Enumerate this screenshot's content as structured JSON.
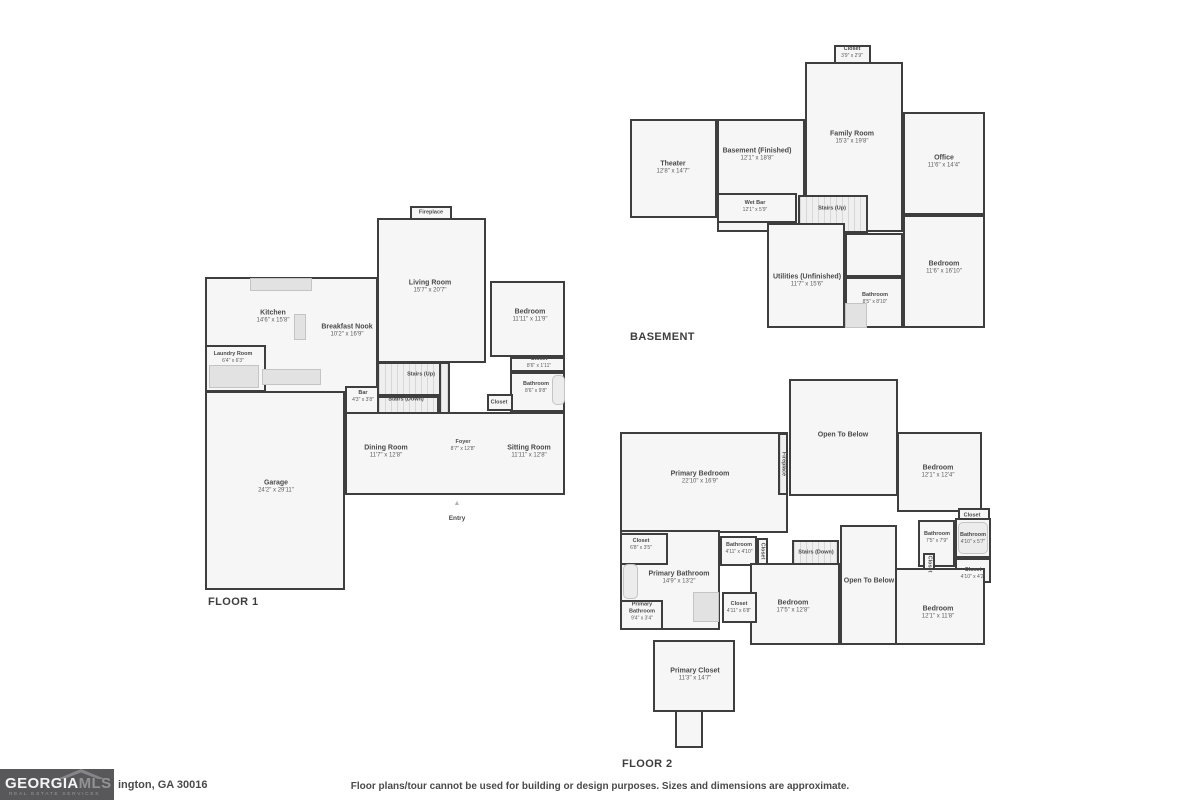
{
  "colors": {
    "wall": "#3e3e3e",
    "room_fill": "#f6f6f6",
    "label_text": "#4a4a4a",
    "logo_bg": "#58585a"
  },
  "footer": {
    "logo_text_1": "GEORGIA",
    "logo_text_2": "MLS",
    "logo_subtext": "REAL ESTATE SERVICES",
    "address": "ington, GA 30016",
    "disclaimer": "Floor plans/tour cannot be used for building or design purposes. Sizes and dimensions are approximate."
  },
  "floorplans": [
    {
      "name": "floor-1",
      "items": [
        {
          "kind": "rect",
          "name": "living-room",
          "x": 377,
          "y": 218,
          "w": 109,
          "h": 145
        },
        {
          "kind": "rect",
          "name": "fireplace-box",
          "x": 410,
          "y": 206,
          "w": 42,
          "h": 14
        },
        {
          "kind": "rect",
          "name": "kitchen-breakfast-area",
          "x": 205,
          "y": 277,
          "w": 173,
          "h": 116
        },
        {
          "kind": "rect",
          "name": "laundry-room",
          "x": 205,
          "y": 345,
          "w": 61,
          "h": 47
        },
        {
          "kind": "rect",
          "name": "garage",
          "x": 205,
          "y": 391,
          "w": 140,
          "h": 199
        },
        {
          "kind": "rect",
          "name": "bar-nook",
          "x": 345,
          "y": 386,
          "w": 35,
          "h": 28
        },
        {
          "kind": "stairs",
          "name": "stairs-up",
          "x": 377,
          "y": 362,
          "w": 73,
          "h": 34
        },
        {
          "kind": "stairs",
          "name": "stairs-down",
          "x": 377,
          "y": 396,
          "w": 62,
          "h": 36
        },
        {
          "kind": "stairs",
          "name": "stair-shaft",
          "x": 439,
          "y": 362,
          "w": 11,
          "h": 128
        },
        {
          "kind": "rect",
          "name": "dining-foyer-sitting-area",
          "x": 345,
          "y": 412,
          "w": 220,
          "h": 83
        },
        {
          "kind": "rect",
          "name": "bedroom",
          "x": 490,
          "y": 281,
          "w": 75,
          "h": 76
        },
        {
          "kind": "rect",
          "name": "closet",
          "x": 510,
          "y": 357,
          "w": 55,
          "h": 15
        },
        {
          "kind": "rect",
          "name": "bathroom",
          "x": 510,
          "y": 372,
          "w": 55,
          "h": 40
        },
        {
          "kind": "rect",
          "name": "foyer-closet",
          "x": 487,
          "y": 394,
          "w": 26,
          "h": 17
        },
        {
          "kind": "fixture",
          "name": "kitchen-counter",
          "x": 250,
          "y": 278,
          "w": 62,
          "h": 13
        },
        {
          "kind": "fixture",
          "name": "kitchen-island",
          "x": 294,
          "y": 314,
          "w": 12,
          "h": 26
        },
        {
          "kind": "fixture",
          "name": "laundry-appliances",
          "x": 209,
          "y": 365,
          "w": 50,
          "h": 23
        },
        {
          "kind": "fixture",
          "name": "kitchen-appliances",
          "x": 262,
          "y": 369,
          "w": 59,
          "h": 16
        },
        {
          "kind": "fixture",
          "name": "bathtub",
          "x": 552,
          "y": 375,
          "w": 13,
          "h": 30,
          "cls": "tub"
        },
        {
          "kind": "label",
          "name": "fireplace-label",
          "text": "Fireplace",
          "x": 431,
          "y": 213,
          "sm": true
        },
        {
          "kind": "label",
          "name": "living-room-label",
          "text": "Living Room",
          "dims": "15'7\" x 20'7\"",
          "x": 430,
          "y": 287
        },
        {
          "kind": "label",
          "name": "kitchen-label",
          "text": "Kitchen",
          "dims": "14'6\" x 15'8\"",
          "x": 273,
          "y": 317
        },
        {
          "kind": "label",
          "name": "breakfast-nook-label",
          "text": "Breakfast Nook",
          "dims": "10'2\" x 16'9\"",
          "x": 347,
          "y": 331
        },
        {
          "kind": "label",
          "name": "laundry-room-label",
          "text": "Laundry Room",
          "dims": "6'4\" x 6'3\"",
          "x": 233,
          "y": 358,
          "sm": true
        },
        {
          "kind": "label",
          "name": "bar-label",
          "text": "Bar",
          "dims": "4'3\" x 3'8\"",
          "x": 363,
          "y": 397,
          "sm": true
        },
        {
          "kind": "label",
          "name": "stairs-up-label",
          "text": "Stairs (Up)",
          "x": 421,
          "y": 375,
          "sm": true
        },
        {
          "kind": "label",
          "name": "stairs-down-label",
          "text": "Stairs (Down)",
          "x": 406,
          "y": 400,
          "sm": true
        },
        {
          "kind": "label",
          "name": "bedroom-label",
          "text": "Bedroom",
          "dims": "11'11\" x 11'9\"",
          "x": 530,
          "y": 316
        },
        {
          "kind": "label",
          "name": "closet-label",
          "text": "Closet",
          "dims": "8'6\" x 1'11\"",
          "x": 539,
          "y": 363,
          "sm": true
        },
        {
          "kind": "label",
          "name": "bathroom-label",
          "text": "Bathroom",
          "dims": "8'6\" x 9'8\"",
          "x": 536,
          "y": 388,
          "sm": true
        },
        {
          "kind": "label",
          "name": "foyer-closet-label",
          "text": "Closet",
          "x": 499,
          "y": 403,
          "sm": true
        },
        {
          "kind": "label",
          "name": "dining-room-label",
          "text": "Dining Room",
          "dims": "11'7\" x 12'8\"",
          "x": 386,
          "y": 452
        },
        {
          "kind": "label",
          "name": "foyer-label",
          "text": "Foyer",
          "dims": "8'7\" x 12'8\"",
          "x": 463,
          "y": 446,
          "sm": true
        },
        {
          "kind": "label",
          "name": "sitting-room-label",
          "text": "Sitting Room",
          "dims": "11'11\" x 12'8\"",
          "x": 529,
          "y": 452
        },
        {
          "kind": "label",
          "name": "garage-label",
          "text": "Garage",
          "dims": "24'2\" x 29'11\"",
          "x": 276,
          "y": 487
        },
        {
          "kind": "entry",
          "name": "entry-marker",
          "text": "Entry",
          "x": 457,
          "y": 500
        },
        {
          "kind": "title",
          "name": "floor-1-title",
          "text": "FLOOR 1",
          "x": 208,
          "y": 596
        }
      ]
    },
    {
      "name": "basement",
      "items": [
        {
          "kind": "rect",
          "name": "closet-top",
          "x": 834,
          "y": 45,
          "w": 37,
          "h": 20
        },
        {
          "kind": "rect",
          "name": "family-room",
          "x": 805,
          "y": 62,
          "w": 98,
          "h": 170
        },
        {
          "kind": "rect",
          "name": "theater",
          "x": 630,
          "y": 119,
          "w": 87,
          "h": 99
        },
        {
          "kind": "rect",
          "name": "basement-finished",
          "x": 717,
          "y": 119,
          "w": 88,
          "h": 113
        },
        {
          "kind": "rect",
          "name": "office",
          "x": 903,
          "y": 112,
          "w": 82,
          "h": 103
        },
        {
          "kind": "rect",
          "name": "wet-bar",
          "x": 717,
          "y": 193,
          "w": 80,
          "h": 30
        },
        {
          "kind": "stairs",
          "name": "stairs-up",
          "x": 798,
          "y": 195,
          "w": 70,
          "h": 38
        },
        {
          "kind": "rect",
          "name": "utilities",
          "x": 767,
          "y": 223,
          "w": 78,
          "h": 105
        },
        {
          "kind": "rect",
          "name": "hallway",
          "x": 845,
          "y": 233,
          "w": 58,
          "h": 44
        },
        {
          "kind": "rect",
          "name": "bathroom",
          "x": 845,
          "y": 277,
          "w": 58,
          "h": 51
        },
        {
          "kind": "rect",
          "name": "bedroom",
          "x": 903,
          "y": 215,
          "w": 82,
          "h": 113
        },
        {
          "kind": "fixture",
          "name": "basement-closet",
          "x": 845,
          "y": 303,
          "w": 22,
          "h": 25
        },
        {
          "kind": "label",
          "name": "closet-top-label",
          "text": "Closet",
          "dims": "3'9\" x 2'9\"",
          "x": 852,
          "y": 53,
          "sm": true
        },
        {
          "kind": "label",
          "name": "family-room-label",
          "text": "Family Room",
          "dims": "15'3\" x 19'8\"",
          "x": 852,
          "y": 138
        },
        {
          "kind": "label",
          "name": "theater-label",
          "text": "Theater",
          "dims": "12'8\" x 14'7\"",
          "x": 673,
          "y": 168
        },
        {
          "kind": "label",
          "name": "basement-finished-label",
          "text": "Basement (Finished)",
          "dims": "12'1\" x 18'8\"",
          "x": 757,
          "y": 155
        },
        {
          "kind": "label",
          "name": "office-label",
          "text": "Office",
          "dims": "11'6\" x 14'4\"",
          "x": 944,
          "y": 162
        },
        {
          "kind": "label",
          "name": "wet-bar-label",
          "text": "Wet Bar",
          "dims": "12'1\" x 5'9\"",
          "x": 755,
          "y": 207,
          "sm": true
        },
        {
          "kind": "label",
          "name": "stairs-up-label",
          "text": "Stairs (Up)",
          "x": 832,
          "y": 209,
          "sm": true
        },
        {
          "kind": "label",
          "name": "utilities-label",
          "text": "Utilities (Unfinished)",
          "dims": "11'7\" x 15'6\"",
          "x": 807,
          "y": 281
        },
        {
          "kind": "label",
          "name": "bathroom-label",
          "text": "Bathroom",
          "dims": "8'5\" x 8'10\"",
          "x": 875,
          "y": 299,
          "sm": true
        },
        {
          "kind": "label",
          "name": "bedroom-label",
          "text": "Bedroom",
          "dims": "11'6\" x 16'10\"",
          "x": 944,
          "y": 268
        },
        {
          "kind": "title",
          "name": "basement-title",
          "text": "BASEMENT",
          "x": 630,
          "y": 331
        }
      ]
    },
    {
      "name": "floor-2",
      "items": [
        {
          "kind": "rect",
          "name": "open-to-below-top",
          "x": 789,
          "y": 379,
          "w": 109,
          "h": 117
        },
        {
          "kind": "rect",
          "name": "primary-bedroom",
          "x": 620,
          "y": 432,
          "w": 168,
          "h": 101
        },
        {
          "kind": "stairs",
          "name": "fireplace-strip",
          "x": 778,
          "y": 433,
          "w": 10,
          "h": 62
        },
        {
          "kind": "rect",
          "name": "bedroom-top-right",
          "x": 897,
          "y": 432,
          "w": 85,
          "h": 80
        },
        {
          "kind": "rect",
          "name": "closet-bump",
          "x": 958,
          "y": 508,
          "w": 32,
          "h": 20
        },
        {
          "kind": "rect",
          "name": "bathroom-right-1",
          "x": 918,
          "y": 520,
          "w": 37,
          "h": 47
        },
        {
          "kind": "rect",
          "name": "closet-vert-right",
          "x": 923,
          "y": 553,
          "w": 12,
          "h": 22
        },
        {
          "kind": "rect",
          "name": "bathroom-right-2",
          "x": 955,
          "y": 518,
          "w": 36,
          "h": 40
        },
        {
          "kind": "rect",
          "name": "closet-right-2",
          "x": 955,
          "y": 558,
          "w": 36,
          "h": 25
        },
        {
          "kind": "rect",
          "name": "bedroom-bottom-right",
          "x": 870,
          "y": 568,
          "w": 115,
          "h": 77
        },
        {
          "kind": "rect",
          "name": "primary-bathroom",
          "x": 620,
          "y": 530,
          "w": 100,
          "h": 100
        },
        {
          "kind": "rect",
          "name": "closet-left",
          "x": 620,
          "y": 533,
          "w": 48,
          "h": 32
        },
        {
          "kind": "rect",
          "name": "bathroom-center",
          "x": 720,
          "y": 536,
          "w": 37,
          "h": 30
        },
        {
          "kind": "rect",
          "name": "closet-vert-center",
          "x": 757,
          "y": 538,
          "w": 11,
          "h": 27
        },
        {
          "kind": "stairs",
          "name": "stairs-down",
          "x": 792,
          "y": 540,
          "w": 47,
          "h": 27
        },
        {
          "kind": "rect",
          "name": "open-to-below-center",
          "x": 840,
          "y": 525,
          "w": 57,
          "h": 120
        },
        {
          "kind": "rect",
          "name": "bedroom-center",
          "x": 750,
          "y": 563,
          "w": 90,
          "h": 82
        },
        {
          "kind": "rect",
          "name": "closet-center",
          "x": 722,
          "y": 592,
          "w": 35,
          "h": 31
        },
        {
          "kind": "rect",
          "name": "primary-bathroom-small",
          "x": 620,
          "y": 600,
          "w": 43,
          "h": 30
        },
        {
          "kind": "rect",
          "name": "primary-closet",
          "x": 653,
          "y": 640,
          "w": 82,
          "h": 72
        },
        {
          "kind": "rect",
          "name": "primary-closet-neck",
          "x": 675,
          "y": 710,
          "w": 28,
          "h": 38
        },
        {
          "kind": "fixture",
          "name": "bathtub-left",
          "x": 623,
          "y": 564,
          "w": 15,
          "h": 35,
          "cls": "tub"
        },
        {
          "kind": "fixture",
          "name": "shower",
          "x": 693,
          "y": 592,
          "w": 26,
          "h": 30
        },
        {
          "kind": "fixture",
          "name": "bathtub-right",
          "x": 958,
          "y": 522,
          "w": 30,
          "h": 32,
          "cls": "tub"
        },
        {
          "kind": "label",
          "name": "open-to-below-top-label",
          "text": "Open To Below",
          "x": 843,
          "y": 435
        },
        {
          "kind": "label",
          "name": "primary-bedroom-label",
          "text": "Primary Bedroom",
          "dims": "22'10\" x 16'9\"",
          "x": 700,
          "y": 478
        },
        {
          "kind": "label",
          "name": "fireplace-label",
          "text": "Fireplace",
          "x": 783,
          "y": 464,
          "sm": true,
          "vert": true
        },
        {
          "kind": "label",
          "name": "bedroom-top-right-label",
          "text": "Bedroom",
          "dims": "12'1\" x 12'4\"",
          "x": 938,
          "y": 472
        },
        {
          "kind": "label",
          "name": "closet-bump-label",
          "text": "Closet",
          "x": 972,
          "y": 516,
          "sm": true
        },
        {
          "kind": "label",
          "name": "bathroom-right-1-label",
          "text": "Bathroom",
          "dims": "7'5\" x 7'9\"",
          "x": 937,
          "y": 538,
          "sm": true
        },
        {
          "kind": "label",
          "name": "closet-vert-right-label",
          "text": "Closet",
          "x": 929,
          "y": 564,
          "sm": true,
          "vert": true
        },
        {
          "kind": "label",
          "name": "bathroom-right-2-label",
          "text": "Bathroom",
          "dims": "4'10\" x 5'7\"",
          "x": 973,
          "y": 539,
          "sm": true
        },
        {
          "kind": "label",
          "name": "closet-right-2-label",
          "text": "Closet",
          "dims": "4'10\" x 4'2\"",
          "x": 973,
          "y": 574,
          "sm": true
        },
        {
          "kind": "label",
          "name": "bedroom-bottom-right-label",
          "text": "Bedroom",
          "dims": "12'1\" x 11'8\"",
          "x": 938,
          "y": 613
        },
        {
          "kind": "label",
          "name": "closet-left-label",
          "text": "Closet",
          "dims": "6'8\" x 3'5\"",
          "x": 641,
          "y": 545,
          "sm": true
        },
        {
          "kind": "label",
          "name": "primary-bathroom-label",
          "text": "Primary Bathroom",
          "dims": "14'9\" x 13'2\"",
          "x": 679,
          "y": 578
        },
        {
          "kind": "label",
          "name": "bathroom-center-label",
          "text": "Bathroom",
          "dims": "4'11\" x 4'10\"",
          "x": 739,
          "y": 549,
          "sm": true
        },
        {
          "kind": "label",
          "name": "closet-vert-center-label",
          "text": "Closet",
          "x": 762,
          "y": 551,
          "sm": true,
          "vert": true
        },
        {
          "kind": "label",
          "name": "stairs-down-label",
          "text": "Stairs (Down)",
          "x": 816,
          "y": 553,
          "sm": true
        },
        {
          "kind": "label",
          "name": "open-to-below-center-label",
          "text": "Open To Below",
          "x": 869,
          "y": 581
        },
        {
          "kind": "label",
          "name": "bedroom-center-label",
          "text": "Bedroom",
          "dims": "17'5\" x 12'8\"",
          "x": 793,
          "y": 607
        },
        {
          "kind": "label",
          "name": "closet-center-label",
          "text": "Closet",
          "dims": "4'11\" x 6'8\"",
          "x": 739,
          "y": 608,
          "sm": true
        },
        {
          "kind": "label",
          "name": "primary-bathroom-small-label",
          "text": "Primary Bathroom",
          "dims": "9'4\" x 3'4\"",
          "x": 642,
          "y": 612,
          "sm": true,
          "wrap": true
        },
        {
          "kind": "label",
          "name": "primary-closet-label",
          "text": "Primary Closet",
          "dims": "11'3\" x 14'7\"",
          "x": 695,
          "y": 675
        },
        {
          "kind": "title",
          "name": "floor-2-title",
          "text": "FLOOR 2",
          "x": 622,
          "y": 758
        }
      ]
    }
  ]
}
